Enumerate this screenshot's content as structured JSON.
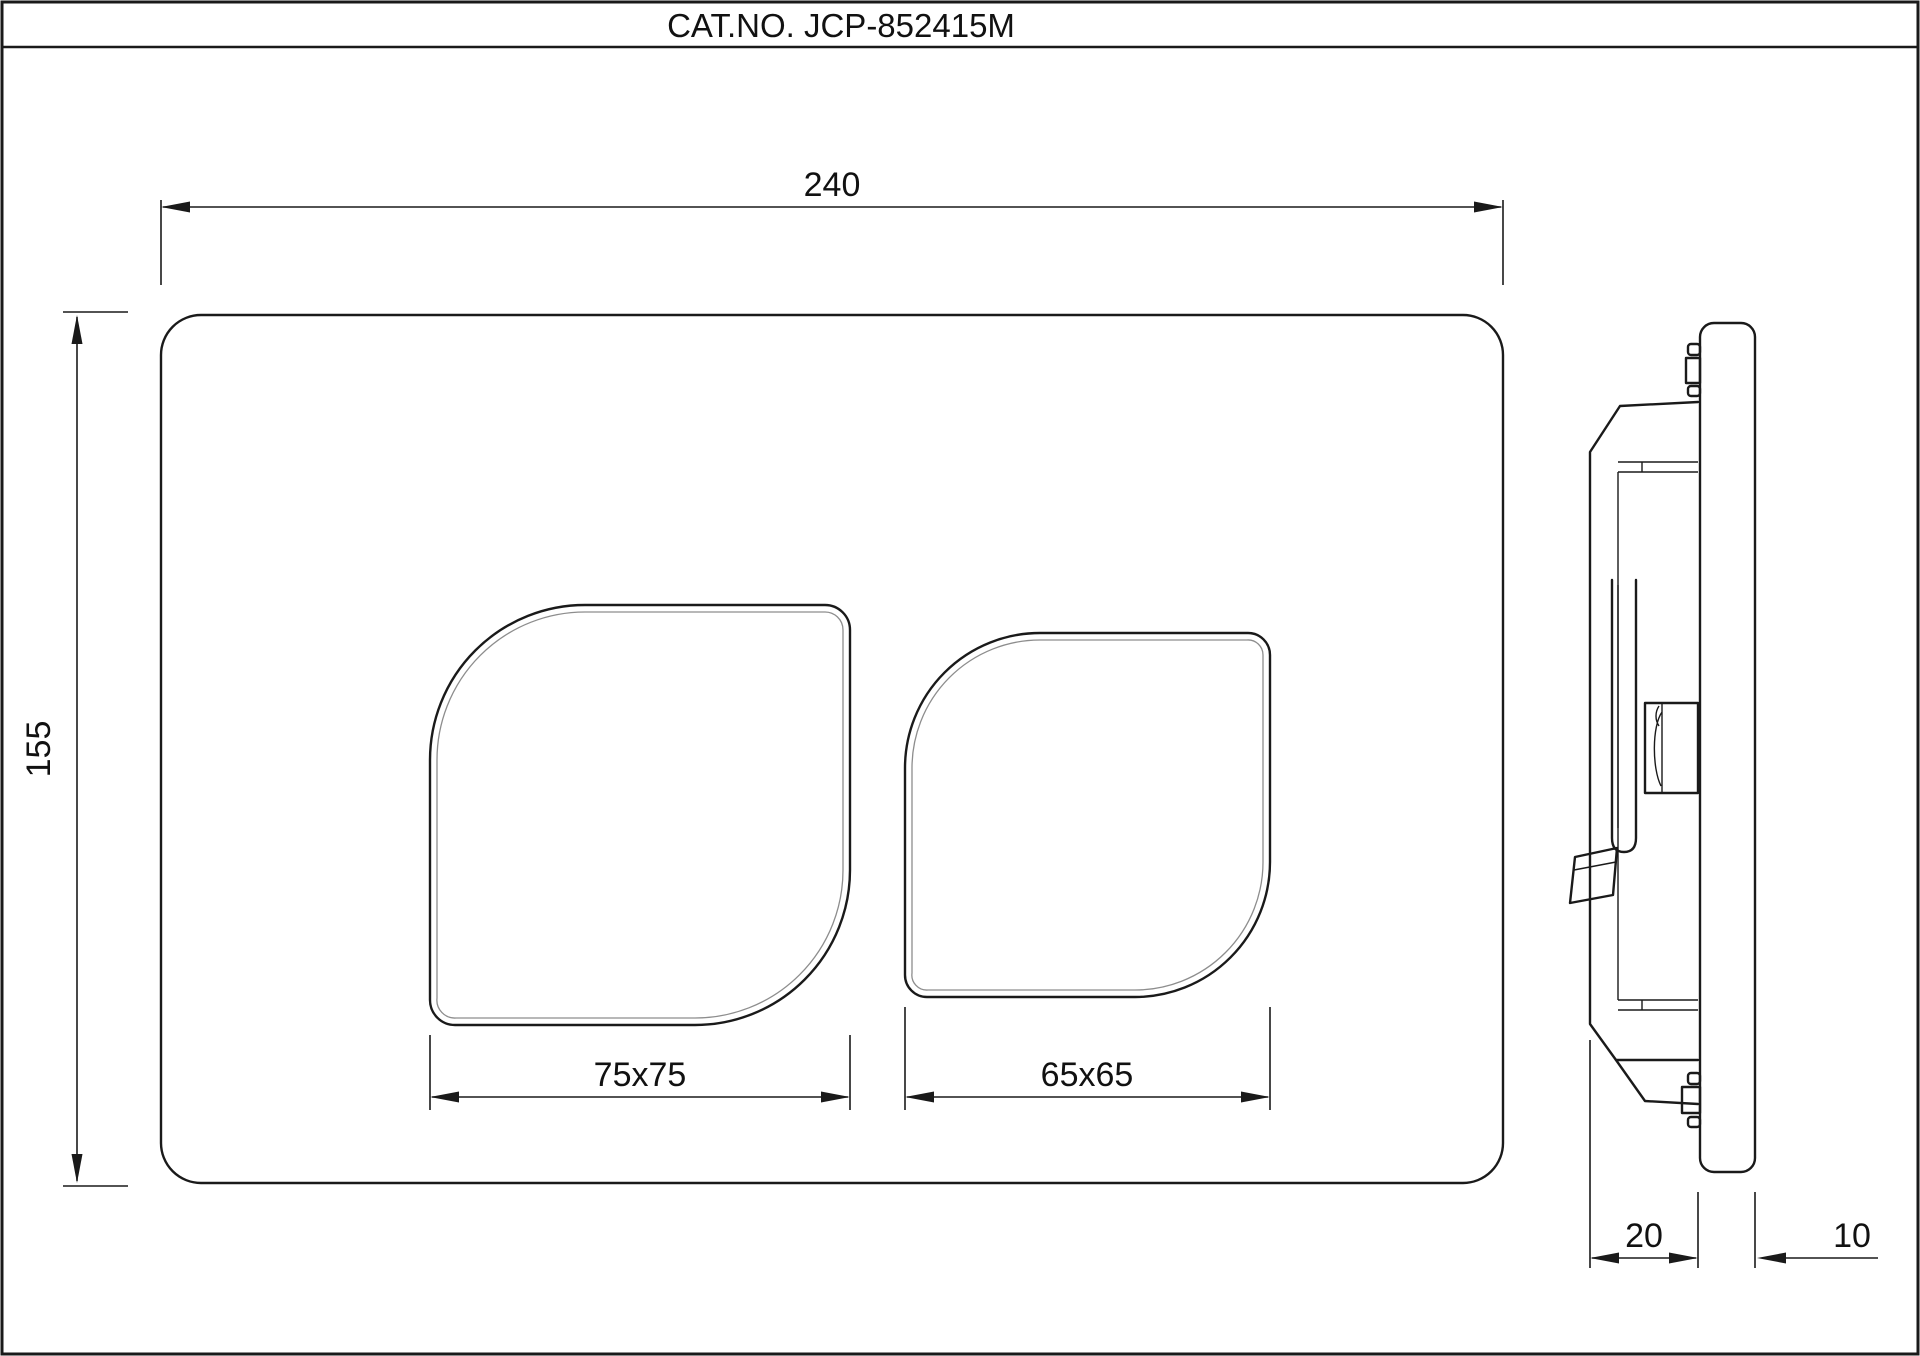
{
  "title_block": {
    "catalog_label": "CAT.NO. JCP-852415M"
  },
  "front_view": {
    "description": "flush plate front elevation",
    "dimensions": {
      "width": "240",
      "height": "155",
      "large_button": "75x75",
      "small_button": "65x65"
    }
  },
  "side_view": {
    "description": "flush plate side profile with mounting frame",
    "dimensions": {
      "frame_depth": "20",
      "plate_thickness": "10"
    }
  },
  "colors": {
    "line": "#1a1a1a",
    "background": "#ffffff",
    "inner_edge": "#8d8d8d"
  }
}
